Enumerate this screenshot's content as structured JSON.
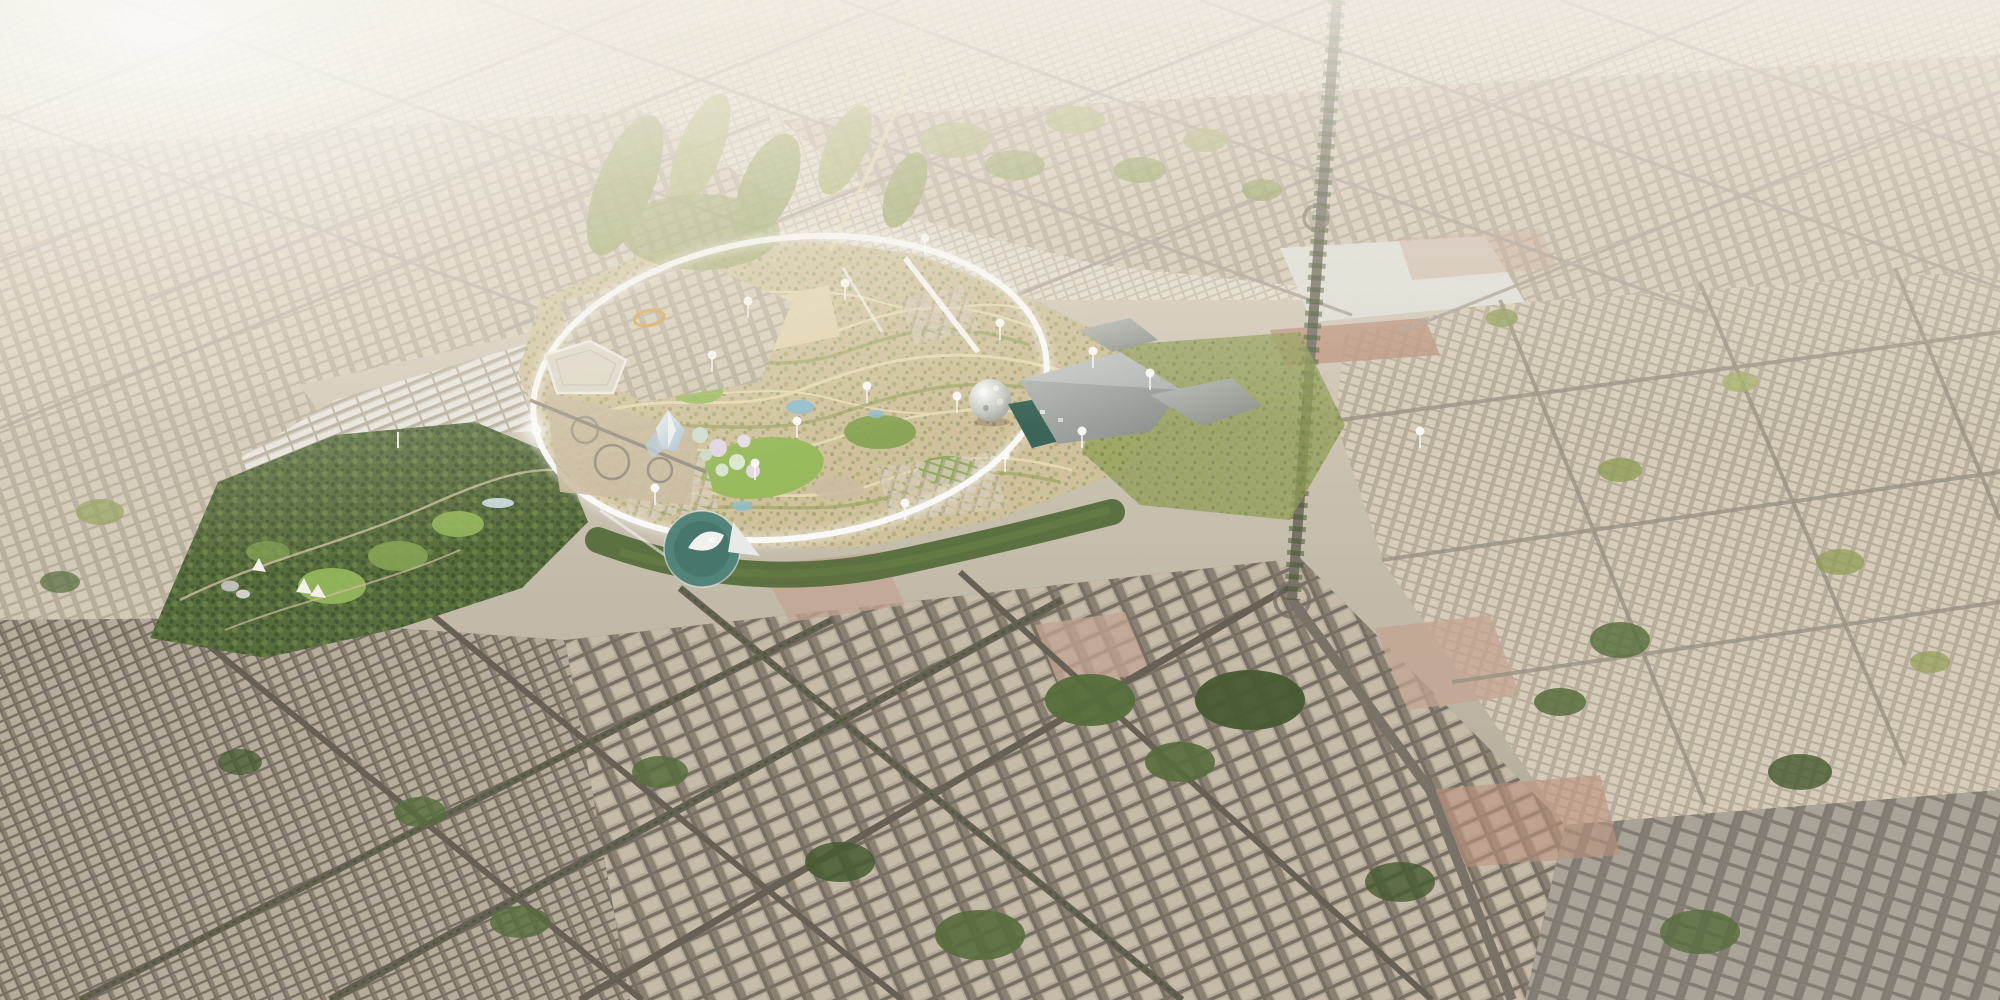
{
  "meta": {
    "description": "Aerial 3D masterplan render of a vast urban park surrounded by desert city fabric, with a white circular loop road around a green wadi park, landmark pavilions, highways and dense low-rise districts stretching to a hazy horizon",
    "view": "oblique-aerial",
    "time_of_day": "hazy daylight"
  },
  "palette": {
    "base-top": "#e9e4da",
    "base-mid": "#cdc5b4",
    "base-low": "#aaa291",
    "street-far": "#c6beac",
    "block-far": "#e4dfd0",
    "street-mid": "#b2a997",
    "block-mid": "#d6cdb9",
    "block-shadow": "#b4aa96",
    "street-near": "#6f685c",
    "block-near": "#b4aa98",
    "block-near-shadow": "#847b6c",
    "block-near-top": "#c4baa7",
    "street-gray": "#7a756b",
    "block-gray": "#a7a195",
    "block-gray-shadow": "#7d776d",
    "road-far": "#a89d94",
    "road-mid": "#948c7e",
    "road-near": "#5d574d",
    "road-hwy": "#716b60",
    "forest": "#4c6532",
    "forest-dark": "#3a5126",
    "forest-lite": "#61793c",
    "olive": "#8b9a4e",
    "olive-light": "#a3ad62",
    "lawn": "#93b854",
    "lawn-dark": "#7fa04a",
    "arid": "#cfc199",
    "wadi": "#e9ddb4",
    "sand": "#c9bb9e",
    "esplanade": "#e3d5ad",
    "teal": "#477e74",
    "teal-roof": "#2f5c50",
    "gray-roof": "#9aa09e",
    "accent-orange": "#d79e3d",
    "water": "#8abccb",
    "glass": "#cfe0ea",
    "pink": "#c2a18e",
    "terracotta": "#b98f78",
    "white": "#ffffff",
    "warehouse": "#e9e7e0"
  },
  "scene": {
    "districts": [
      {
        "name": "hazy-horizon-city",
        "area": "top band"
      },
      {
        "name": "old-grid-city-northwest",
        "area": "upper left"
      },
      {
        "name": "old-grid-city-northeast",
        "area": "upper right"
      },
      {
        "name": "eastern-new-districts",
        "area": "right of loop"
      },
      {
        "name": "warehouse-district",
        "area": "west of park"
      },
      {
        "name": "foreground-city-south",
        "area": "bottom half"
      },
      {
        "name": "forest-park-west",
        "area": "left park lobe"
      },
      {
        "name": "central-wadi-park",
        "area": "inside loop"
      }
    ],
    "landmarks": [
      {
        "name": "loop-ring-road",
        "x": 790,
        "y": 388
      },
      {
        "name": "geodesic-sphere-pavilion",
        "x": 990,
        "y": 400
      },
      {
        "name": "arts-complex-roofs",
        "x": 1090,
        "y": 400
      },
      {
        "name": "teal-round-plaza",
        "x": 702,
        "y": 549
      },
      {
        "name": "crystal-pavilion",
        "x": 668,
        "y": 434
      },
      {
        "name": "pentagon-hall",
        "x": 582,
        "y": 368
      },
      {
        "name": "highway-interchange-west",
        "x": 615,
        "y": 455
      },
      {
        "name": "orange-stadium-ring",
        "x": 649,
        "y": 318
      },
      {
        "name": "flowering-grove",
        "x": 725,
        "y": 452
      },
      {
        "name": "eastern-highway",
        "x": 1310,
        "y": 300
      },
      {
        "name": "south-junction",
        "x": 1292,
        "y": 600
      }
    ],
    "markers": [
      [
        712,
        372
      ],
      [
        797,
        438
      ],
      [
        867,
        403
      ],
      [
        957,
        413
      ],
      [
        1005,
        472
      ],
      [
        1082,
        448
      ],
      [
        925,
        255
      ],
      [
        1000,
        340
      ],
      [
        1093,
        368
      ],
      [
        845,
        300
      ],
      [
        755,
        480
      ],
      [
        655,
        505
      ],
      [
        905,
        520
      ],
      [
        1150,
        390
      ],
      [
        1420,
        448
      ],
      [
        748,
        318
      ]
    ]
  }
}
